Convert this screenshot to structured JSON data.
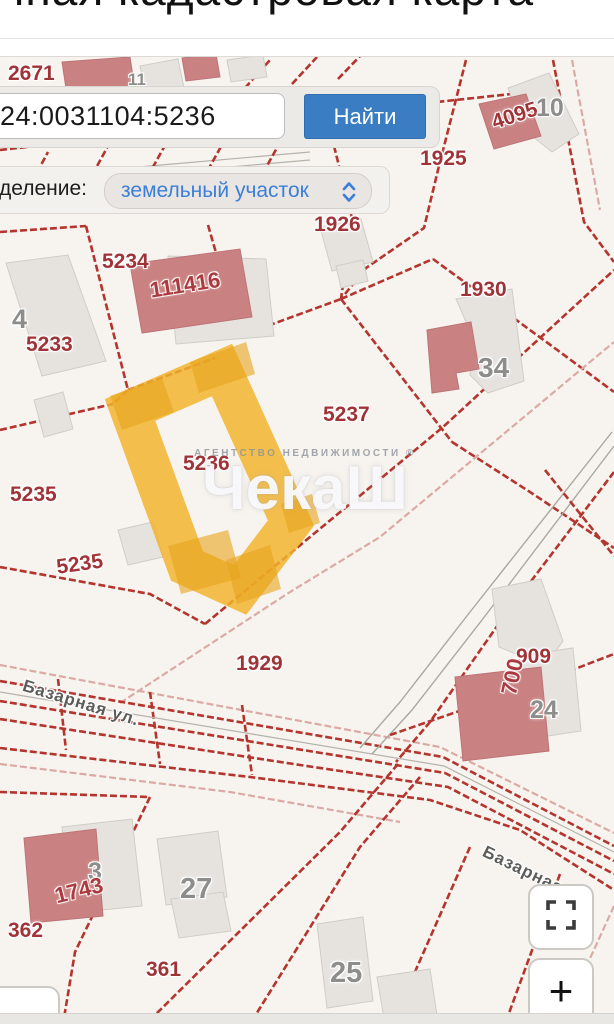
{
  "page": {
    "title": "Публичная кадастровая карта"
  },
  "search": {
    "value": "24:0031104:5236",
    "button_label": "Найти"
  },
  "filter": {
    "label": "деление:",
    "value": "земельный участок"
  },
  "watermark": {
    "line1": "АГЕНТСТВО НЕДВИЖИМОСТИ ®",
    "logo": "ЧекаШ"
  },
  "controls": {
    "zoom_in_label": "+"
  },
  "map": {
    "background": "#f7f4ef",
    "selected_parcel": {
      "number": "5236",
      "color": "#f2b32b",
      "outline_points": "222,370 291,523 240,590 187,566 130,410"
    },
    "labels": [
      {
        "text": "2671",
        "x": 8,
        "y": 62,
        "cls": "r"
      },
      {
        "text": "11",
        "x": 128,
        "y": 70,
        "cls": "g",
        "size": 17
      },
      {
        "text": "1925",
        "x": 420,
        "y": 147,
        "cls": "r"
      },
      {
        "text": "4095",
        "x": 489,
        "y": 112,
        "cls": "r",
        "rot": -18
      },
      {
        "text": "10",
        "x": 536,
        "y": 94,
        "cls": "g"
      },
      {
        "text": "1926",
        "x": 314,
        "y": 213,
        "cls": "r"
      },
      {
        "text": "5234",
        "x": 102,
        "y": 250,
        "cls": "r"
      },
      {
        "text": "111416",
        "x": 148,
        "y": 278,
        "cls": "e",
        "rot": -9
      },
      {
        "text": "4",
        "x": 12,
        "y": 304,
        "cls": "g",
        "size": 27
      },
      {
        "text": "5233",
        "x": 26,
        "y": 333,
        "cls": "r"
      },
      {
        "text": "1930",
        "x": 460,
        "y": 278,
        "cls": "r"
      },
      {
        "text": "34",
        "x": 478,
        "y": 352,
        "cls": "g",
        "size": 28
      },
      {
        "text": "5237",
        "x": 323,
        "y": 403,
        "cls": "r"
      },
      {
        "text": "5236",
        "x": 183,
        "y": 452,
        "cls": "r"
      },
      {
        "text": "5235",
        "x": 10,
        "y": 483,
        "cls": "r"
      },
      {
        "text": "5235",
        "x": 55,
        "y": 556,
        "cls": "r",
        "rot": -8
      },
      {
        "text": "1929",
        "x": 236,
        "y": 652,
        "cls": "r"
      },
      {
        "text": "909",
        "x": 516,
        "y": 645,
        "cls": "r"
      },
      {
        "text": "700",
        "x": 496,
        "y": 692,
        "cls": "e",
        "rot": -78
      },
      {
        "text": "24",
        "x": 530,
        "y": 696,
        "cls": "g"
      },
      {
        "text": "3",
        "x": 88,
        "y": 858,
        "cls": "g"
      },
      {
        "text": "1743",
        "x": 52,
        "y": 884,
        "cls": "e",
        "rot": -14
      },
      {
        "text": "27",
        "x": 180,
        "y": 873,
        "cls": "g",
        "size": 29
      },
      {
        "text": "362",
        "x": 8,
        "y": 919,
        "cls": "r"
      },
      {
        "text": "361",
        "x": 146,
        "y": 958,
        "cls": "r"
      },
      {
        "text": "25",
        "x": 330,
        "y": 957,
        "cls": "g",
        "size": 29
      },
      {
        "text": "Базарная ул.",
        "x": 26,
        "y": 676,
        "cls": "s",
        "rot": 17
      },
      {
        "text": "Базарная ул",
        "x": 488,
        "y": 842,
        "cls": "s",
        "rot": 26
      }
    ],
    "buildings": [
      {
        "t": "g",
        "pts": "140,66 178,59 184,88 146,95"
      },
      {
        "t": "g",
        "pts": "227,60 263,55 267,77 231,82"
      },
      {
        "t": "g",
        "pts": "508,88 549,73 579,134 552,152 522,128"
      },
      {
        "t": "g",
        "pts": "320,227 361,219 373,262 332,271"
      },
      {
        "t": "g",
        "pts": "336,266 363,260 368,281 341,288"
      },
      {
        "t": "g",
        "pts": "168,256 266,259 274,336 176,344"
      },
      {
        "t": "g",
        "pts": "6,263 68,255 106,361 42,376"
      },
      {
        "t": "g",
        "pts": "34,400 63,392 73,429 44,437"
      },
      {
        "t": "g",
        "pts": "118,530 153,522 163,557 128,565"
      },
      {
        "t": "g",
        "pts": "456,299 512,289 524,381 488,393 470,375 474,340"
      },
      {
        "t": "g",
        "pts": "492,589 541,579 563,641 545,666 499,647"
      },
      {
        "t": "g",
        "pts": "520,656 573,648 581,731 528,739"
      },
      {
        "t": "g",
        "pts": "62,827 132,819 142,906 72,913"
      },
      {
        "t": "g",
        "pts": "157,839 218,831 227,897 166,905"
      },
      {
        "t": "g",
        "pts": "171,899 223,892 231,931 179,938"
      },
      {
        "t": "g",
        "pts": "317,924 363,917 373,1001 327,1008"
      },
      {
        "t": "g",
        "pts": "377,977 430,969 438,1022 385,1024"
      },
      {
        "t": "r",
        "pts": "62,62 130,57 135,90 67,95"
      },
      {
        "t": "r",
        "pts": "182,58 216,54 220,77 186,81"
      },
      {
        "t": "r",
        "pts": "479,104 526,94 541,136 494,149"
      },
      {
        "t": "r",
        "pts": "130,264 240,249 252,317 142,333"
      },
      {
        "t": "r",
        "pts": "427,330 471,322 479,369 456,373 459,389 432,393"
      },
      {
        "t": "r",
        "pts": "455,677 541,667 549,751 463,761"
      },
      {
        "t": "r",
        "pts": "24,838 96,829 103,916 31,923"
      }
    ],
    "selected_buildings": [
      {
        "pts": "110,396 162,378 174,412 122,430"
      },
      {
        "pts": "190,362 246,342 255,374 199,393"
      },
      {
        "pts": "168,546 228,530 241,578 181,594"
      },
      {
        "pts": "226,560 270,545 281,589 237,604"
      },
      {
        "pts": "281,504 312,494 320,523 289,533"
      }
    ],
    "lines": [
      {
        "c": "b",
        "pts": "0,150 250,122 530,92"
      },
      {
        "c": "b",
        "pts": "0,212 160,190 310,172"
      },
      {
        "c": "g",
        "pts": "0,180 150,166 310,152"
      },
      {
        "c": "g",
        "pts": "0,188 150,174 310,160"
      },
      {
        "c": "b",
        "pts": "18,208 48,152"
      },
      {
        "c": "b",
        "pts": "78,201 108,146"
      },
      {
        "c": "b",
        "pts": "138,194 168,140"
      },
      {
        "c": "b",
        "pts": "198,188 228,134"
      },
      {
        "c": "b",
        "pts": "258,182 288,128"
      },
      {
        "c": "b",
        "pts": "245,88 270,60"
      },
      {
        "c": "b",
        "pts": "292,84 317,57"
      },
      {
        "c": "b",
        "pts": "338,79 363,53"
      },
      {
        "c": "b",
        "pts": "0,114 58,97"
      },
      {
        "c": "b",
        "pts": "466,60 438,170 424,228 366,268 341,299"
      },
      {
        "c": "b",
        "pts": "334,146 352,218 341,299"
      },
      {
        "c": "b",
        "pts": "553,60 584,222 614,262"
      },
      {
        "c": "p",
        "pts": "572,60 600,210"
      },
      {
        "c": "b",
        "pts": "341,299 433,259"
      },
      {
        "c": "b",
        "pts": "433,259 560,352 614,392"
      },
      {
        "c": "b",
        "pts": "341,299 452,442"
      },
      {
        "c": "b",
        "pts": "452,442 530,492 614,548"
      },
      {
        "c": "b",
        "pts": "208,225 240,336"
      },
      {
        "c": "b",
        "pts": "240,336 341,299"
      },
      {
        "c": "b",
        "pts": "0,232 86,226"
      },
      {
        "c": "b",
        "pts": "86,226 128,390 113,404"
      },
      {
        "c": "b",
        "pts": "0,430 113,404"
      },
      {
        "c": "b",
        "pts": "128,390 215,358"
      },
      {
        "c": "b",
        "pts": "0,567 150,594 205,624"
      },
      {
        "c": "b",
        "pts": "205,624 310,537 443,427 614,270"
      },
      {
        "c": "p",
        "pts": "120,703 290,592 380,537 614,342"
      },
      {
        "c": "p",
        "pts": "0,665 440,747 614,833"
      },
      {
        "c": "b",
        "pts": "0,681 443,757 614,846"
      },
      {
        "c": "b",
        "pts": "0,701 445,773 614,861"
      },
      {
        "c": "b",
        "pts": "0,719 300,765 448,787 614,874"
      },
      {
        "c": "b",
        "pts": "0,748 250,777 430,800 520,830 614,890"
      },
      {
        "c": "p",
        "pts": "0,764 230,792 400,822"
      },
      {
        "c": "b",
        "pts": "150,692 160,764"
      },
      {
        "c": "b",
        "pts": "58,679 66,750"
      },
      {
        "c": "b",
        "pts": "242,705 252,775"
      },
      {
        "c": "g",
        "pts": "0,692 444,766 614,852"
      },
      {
        "c": "gd",
        "pts": "612,432 470,612 400,702 360,748"
      },
      {
        "c": "gd",
        "pts": "614,446 482,620 412,710 372,754"
      },
      {
        "c": "b",
        "pts": "614,472 500,622 430,722 396,762"
      },
      {
        "c": "b",
        "pts": "545,470 614,556"
      },
      {
        "c": "b",
        "pts": "390,735 520,690 614,654"
      },
      {
        "c": "b",
        "pts": "398,764 340,832 150,1020"
      },
      {
        "c": "b",
        "pts": "420,777 360,847 250,1024"
      },
      {
        "c": "b",
        "pts": "150,797 75,952 63,1024"
      },
      {
        "c": "b",
        "pts": "0,792 150,797"
      },
      {
        "c": "b",
        "pts": "470,847 392,1024"
      },
      {
        "c": "b",
        "pts": "560,874 505,1024"
      },
      {
        "c": "p",
        "pts": "614,906 560,1024"
      }
    ]
  }
}
